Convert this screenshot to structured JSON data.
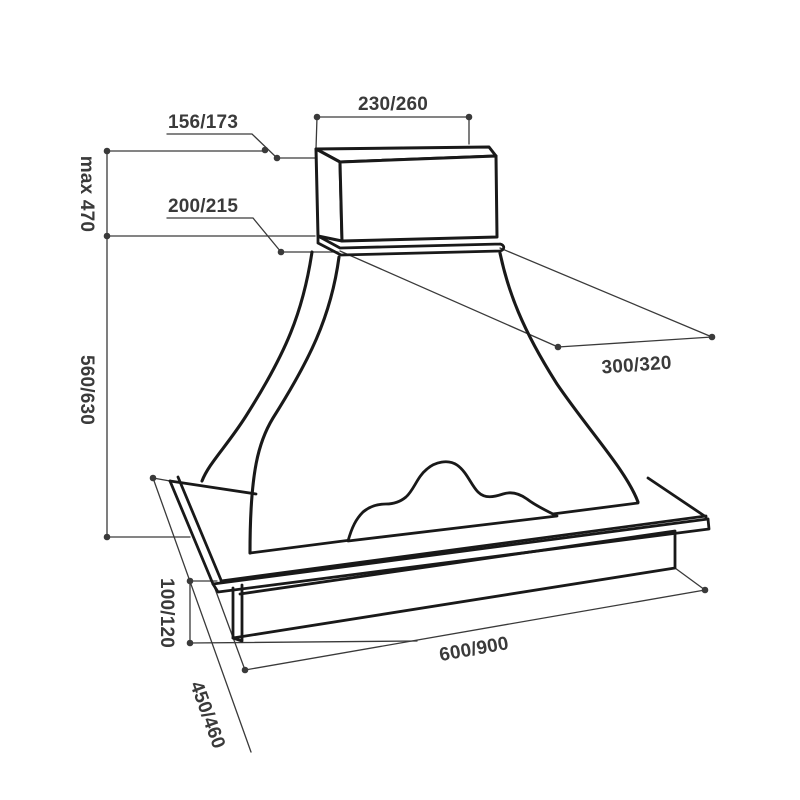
{
  "drawing": {
    "title": "range hood dimension drawing",
    "colors": {
      "outline": "#191919",
      "dimension": "#3a3a3a",
      "background": "#ffffff"
    },
    "labels": {
      "duct_top_width": "230/260",
      "duct_offset": "156/173",
      "max_height": "max 470",
      "collar": "200/215",
      "top_depth": "300/320",
      "body_height": "560/630",
      "base_height": "100/120",
      "base_depth": "450/460",
      "base_width": "600/900"
    }
  }
}
